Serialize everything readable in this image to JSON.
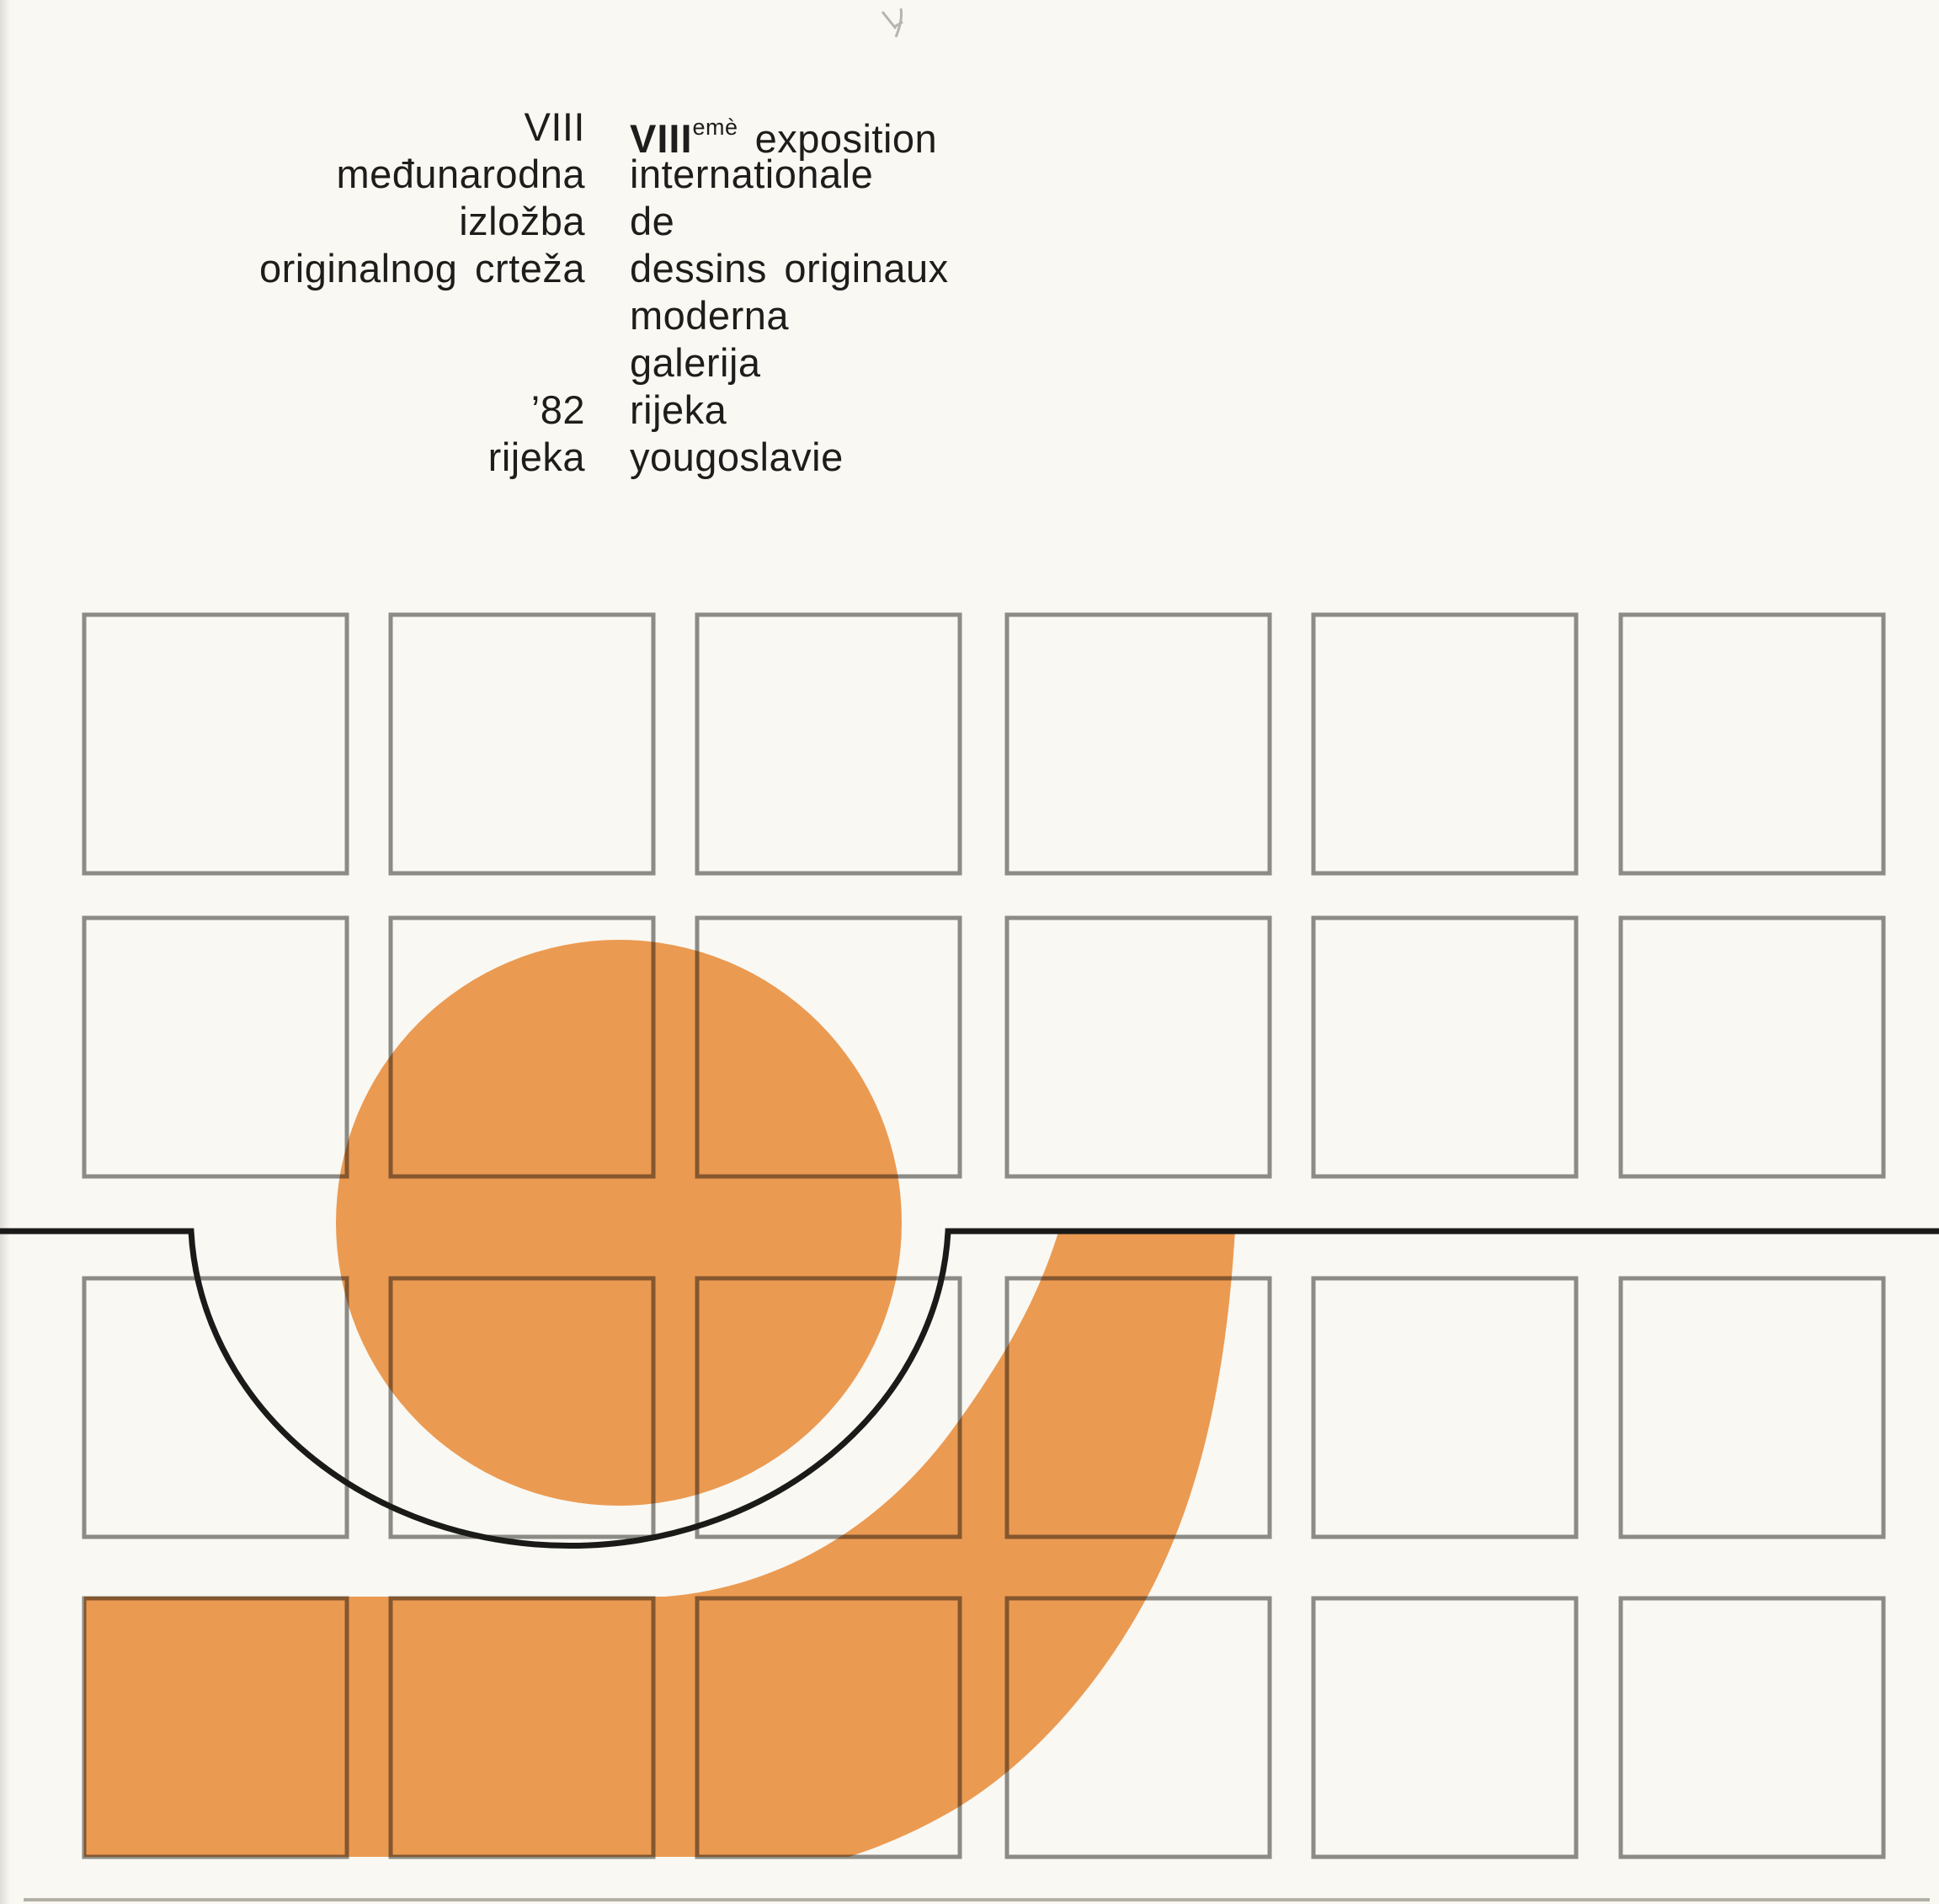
{
  "document": {
    "title_block": {
      "croatian": {
        "lines": [
          "VIII",
          "međunarodna",
          "izložba",
          "originalnog crteža",
          "’82",
          "rijeka"
        ]
      },
      "french": {
        "line1": {
          "roman": "VIII",
          "superscript": "emè",
          "word": "exposition"
        },
        "lines": [
          "internationale",
          "de",
          "dessins originaux",
          "moderna",
          "galerija",
          "rijeka",
          "yougoslavie"
        ]
      }
    },
    "colors": {
      "orange": "#eb9a52",
      "grid_gray": "#8f8f8d",
      "line_black": "#1a1a18",
      "background": "#f9f8f3",
      "text": "#1e1d1b"
    },
    "grid": {
      "columns": 6,
      "rows": 4
    }
  }
}
